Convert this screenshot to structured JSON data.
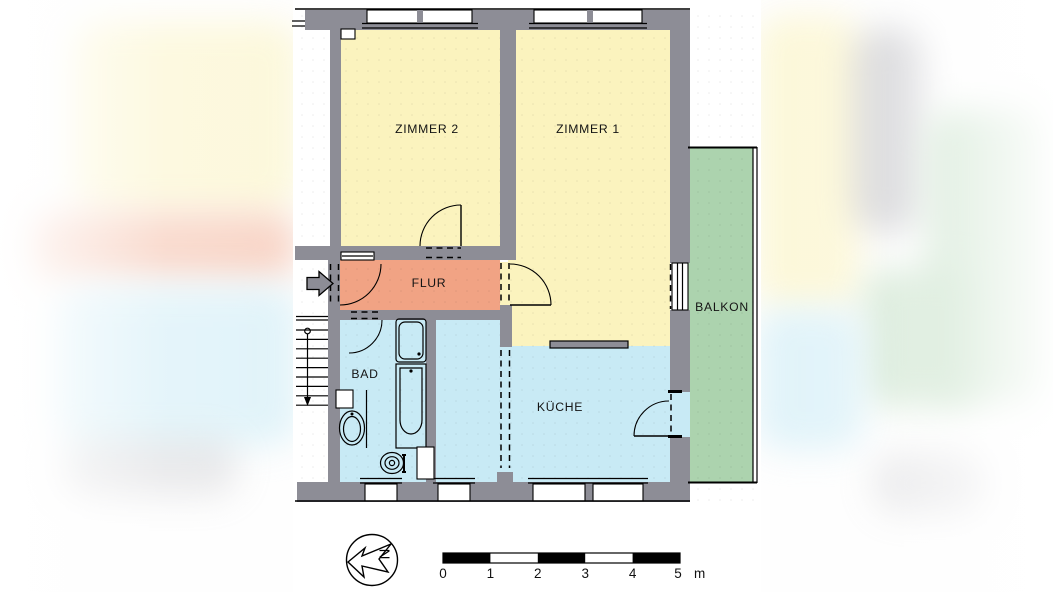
{
  "colors": {
    "wall": "#8D8D96",
    "line": "#000000",
    "zimmer_yellow": "#FBF3BE",
    "flur_orange": "#F1A384",
    "wet_blue": "#C8EAF5",
    "balkon_green": "#ACD3AE"
  },
  "rooms": {
    "zimmer2": {
      "label": "ZIMMER 2"
    },
    "zimmer1": {
      "label": "ZIMMER 1"
    },
    "flur": {
      "label": "FLUR"
    },
    "bad": {
      "label": "BAD"
    },
    "kueche": {
      "label": "KÜCHE"
    },
    "balkon": {
      "label": "BALKON"
    }
  },
  "compass": {
    "north_letter": "N"
  },
  "scale_bar": {
    "ticks": [
      "0",
      "1",
      "2",
      "3",
      "4",
      "5"
    ],
    "unit": "m"
  }
}
